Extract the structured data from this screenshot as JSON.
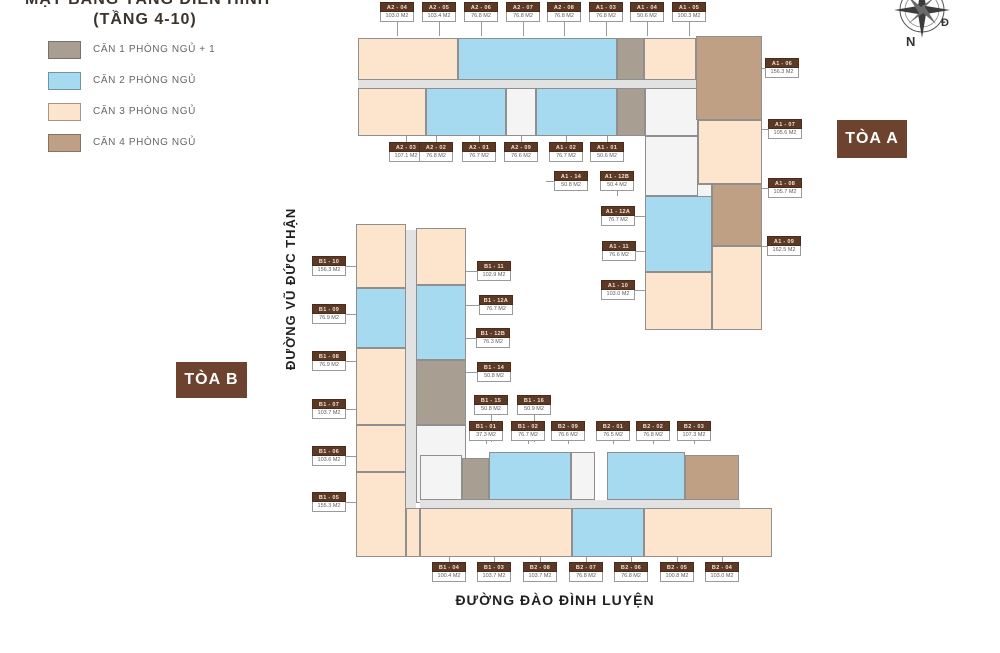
{
  "title": {
    "line1": "MẶT BẰNG TẦNG ĐIỂN HÌNH",
    "line2": "(TẦNG 4-10)"
  },
  "legend": [
    {
      "label": "CĂN 1 PHÒNG NGỦ + 1",
      "color": "#a89f92"
    },
    {
      "label": "CĂN 2 PHÒNG NGỦ",
      "color": "#a5daf0"
    },
    {
      "label": "CĂN 3 PHÒNG NGỦ",
      "color": "#fce4cd"
    },
    {
      "label": "CĂN 4 PHÒNG NGỦ",
      "color": "#bfa084"
    }
  ],
  "towers": {
    "a": "TÒA A",
    "b": "TÒA B"
  },
  "streets": {
    "left": "ĐƯỜNG VŨ ĐỨC THẬN",
    "bottom": "ĐƯỜNG ĐÀO ĐÌNH LUYỆN"
  },
  "compass": {
    "south": "N",
    "east": "Đ"
  },
  "units": [
    {
      "code": "A2 - 04",
      "area": "103.0 M2",
      "x": 380,
      "y": 2,
      "dir": "down",
      "lead": 14
    },
    {
      "code": "A2 - 05",
      "area": "103.4 M2",
      "x": 422,
      "y": 2,
      "dir": "down",
      "lead": 14
    },
    {
      "code": "A2 - 06",
      "area": "76.8 M2",
      "x": 464,
      "y": 2,
      "dir": "down",
      "lead": 14
    },
    {
      "code": "A2 - 07",
      "area": "76.8 M2",
      "x": 506,
      "y": 2,
      "dir": "down",
      "lead": 14
    },
    {
      "code": "A2 - 08",
      "area": "76.8 M2",
      "x": 547,
      "y": 2,
      "dir": "down",
      "lead": 14
    },
    {
      "code": "A1 - 03",
      "area": "76.8 M2",
      "x": 589,
      "y": 2,
      "dir": "down",
      "lead": 14
    },
    {
      "code": "A1 - 04",
      "area": "50.6 M2",
      "x": 630,
      "y": 2,
      "dir": "down",
      "lead": 14
    },
    {
      "code": "A1 - 05",
      "area": "100.3 M2",
      "x": 672,
      "y": 2,
      "dir": "down",
      "lead": 14
    },
    {
      "code": "A2 - 03",
      "area": "107.1 M2",
      "x": 389,
      "y": 142,
      "dir": "up",
      "lead": 6
    },
    {
      "code": "A2 - 02",
      "area": "76.8 M2",
      "x": 419,
      "y": 142,
      "dir": "up",
      "lead": 6
    },
    {
      "code": "A2 - 01",
      "area": "76.7 M2",
      "x": 462,
      "y": 142,
      "dir": "up",
      "lead": 6
    },
    {
      "code": "A2 - 09",
      "area": "76.6 M2",
      "x": 504,
      "y": 142,
      "dir": "up",
      "lead": 6
    },
    {
      "code": "A1 - 02",
      "area": "76.7 M2",
      "x": 549,
      "y": 142,
      "dir": "up",
      "lead": 6
    },
    {
      "code": "A1 - 01",
      "area": "50.6 M2",
      "x": 590,
      "y": 142,
      "dir": "up",
      "lead": 6
    },
    {
      "code": "A1 - 14",
      "area": "50.8 M2",
      "x": 554,
      "y": 171,
      "dir": "left",
      "lead": 8
    },
    {
      "code": "A1 - 12B",
      "area": "50.4 M2",
      "x": 600,
      "y": 171,
      "dir": "down",
      "lead": 5
    },
    {
      "code": "A1 - 12A",
      "area": "76.7 M2",
      "x": 601,
      "y": 206,
      "dir": "right",
      "lead": 10
    },
    {
      "code": "A1 - 11",
      "area": "76.6 M2",
      "x": 602,
      "y": 241,
      "dir": "right",
      "lead": 9
    },
    {
      "code": "A1 - 10",
      "area": "103.0 M2",
      "x": 601,
      "y": 280,
      "dir": "right",
      "lead": 10
    },
    {
      "code": "A1 - 06",
      "area": "156.3 M2",
      "x": 765,
      "y": 58,
      "dir": "left",
      "lead": 3
    },
    {
      "code": "A1 - 07",
      "area": "105.6 M2",
      "x": 768,
      "y": 119,
      "dir": "left",
      "lead": 6
    },
    {
      "code": "A1 - 08",
      "area": "105.7 M2",
      "x": 768,
      "y": 178,
      "dir": "left",
      "lead": 6
    },
    {
      "code": "A1 - 09",
      "area": "162.5 M2",
      "x": 767,
      "y": 236,
      "dir": "left",
      "lead": 5
    },
    {
      "code": "B1 - 10",
      "area": "156.3 M2",
      "x": 312,
      "y": 256,
      "dir": "right",
      "lead": 10
    },
    {
      "code": "B1 - 09",
      "area": "76.9 M2",
      "x": 312,
      "y": 304,
      "dir": "right",
      "lead": 10
    },
    {
      "code": "B1 - 08",
      "area": "76.9 M2",
      "x": 312,
      "y": 351,
      "dir": "right",
      "lead": 10
    },
    {
      "code": "B1 - 07",
      "area": "103.7 M2",
      "x": 312,
      "y": 399,
      "dir": "right",
      "lead": 10
    },
    {
      "code": "B1 - 06",
      "area": "103.6 M2",
      "x": 312,
      "y": 446,
      "dir": "right",
      "lead": 10
    },
    {
      "code": "B1 - 05",
      "area": "155.3 M2",
      "x": 312,
      "y": 492,
      "dir": "right",
      "lead": 10
    },
    {
      "code": "B1 - 11",
      "area": "102.9 M2",
      "x": 477,
      "y": 261,
      "dir": "left",
      "lead": 11
    },
    {
      "code": "B1 - 12A",
      "area": "76.7 M2",
      "x": 479,
      "y": 295,
      "dir": "left",
      "lead": 13
    },
    {
      "code": "B1 - 12B",
      "area": "76.3 M2",
      "x": 476,
      "y": 328,
      "dir": "left",
      "lead": 10
    },
    {
      "code": "B1 - 14",
      "area": "50.8 M2",
      "x": 477,
      "y": 362,
      "dir": "left",
      "lead": 11
    },
    {
      "code": "B1 - 15",
      "area": "50.8 M2",
      "x": 474,
      "y": 395,
      "dir": "down",
      "lead": 27
    },
    {
      "code": "B1 - 16",
      "area": "50.9 M2",
      "x": 517,
      "y": 395,
      "dir": "down",
      "lead": 27
    },
    {
      "code": "B1 - 01",
      "area": "37.3 M2",
      "x": 469,
      "y": 421,
      "dir": "down",
      "lead": 3
    },
    {
      "code": "B1 - 02",
      "area": "76.7 M2",
      "x": 511,
      "y": 421,
      "dir": "down",
      "lead": 3
    },
    {
      "code": "B2 - 09",
      "area": "76.6 M2",
      "x": 551,
      "y": 421,
      "dir": "down",
      "lead": 3
    },
    {
      "code": "B2 - 01",
      "area": "76.5 M2",
      "x": 596,
      "y": 421,
      "dir": "down",
      "lead": 3
    },
    {
      "code": "B2 - 02",
      "area": "76.8 M2",
      "x": 636,
      "y": 421,
      "dir": "down",
      "lead": 3
    },
    {
      "code": "B2 - 03",
      "area": "107.3 M2",
      "x": 677,
      "y": 421,
      "dir": "down",
      "lead": 3
    },
    {
      "code": "B1 - 04",
      "area": "100.4 M2",
      "x": 432,
      "y": 562,
      "dir": "up",
      "lead": 5
    },
    {
      "code": "B1 - 03",
      "area": "103.7 M2",
      "x": 477,
      "y": 562,
      "dir": "up",
      "lead": 5
    },
    {
      "code": "B2 - 08",
      "area": "103.7 M2",
      "x": 523,
      "y": 562,
      "dir": "up",
      "lead": 5
    },
    {
      "code": "B2 - 07",
      "area": "76.8 M2",
      "x": 569,
      "y": 562,
      "dir": "up",
      "lead": 5
    },
    {
      "code": "B2 - 06",
      "area": "76.8 M2",
      "x": 614,
      "y": 562,
      "dir": "up",
      "lead": 5
    },
    {
      "code": "B2 - 05",
      "area": "100.8 M2",
      "x": 660,
      "y": 562,
      "dir": "up",
      "lead": 5
    },
    {
      "code": "B2 - 04",
      "area": "103.0 M2",
      "x": 705,
      "y": 562,
      "dir": "up",
      "lead": 5
    }
  ]
}
